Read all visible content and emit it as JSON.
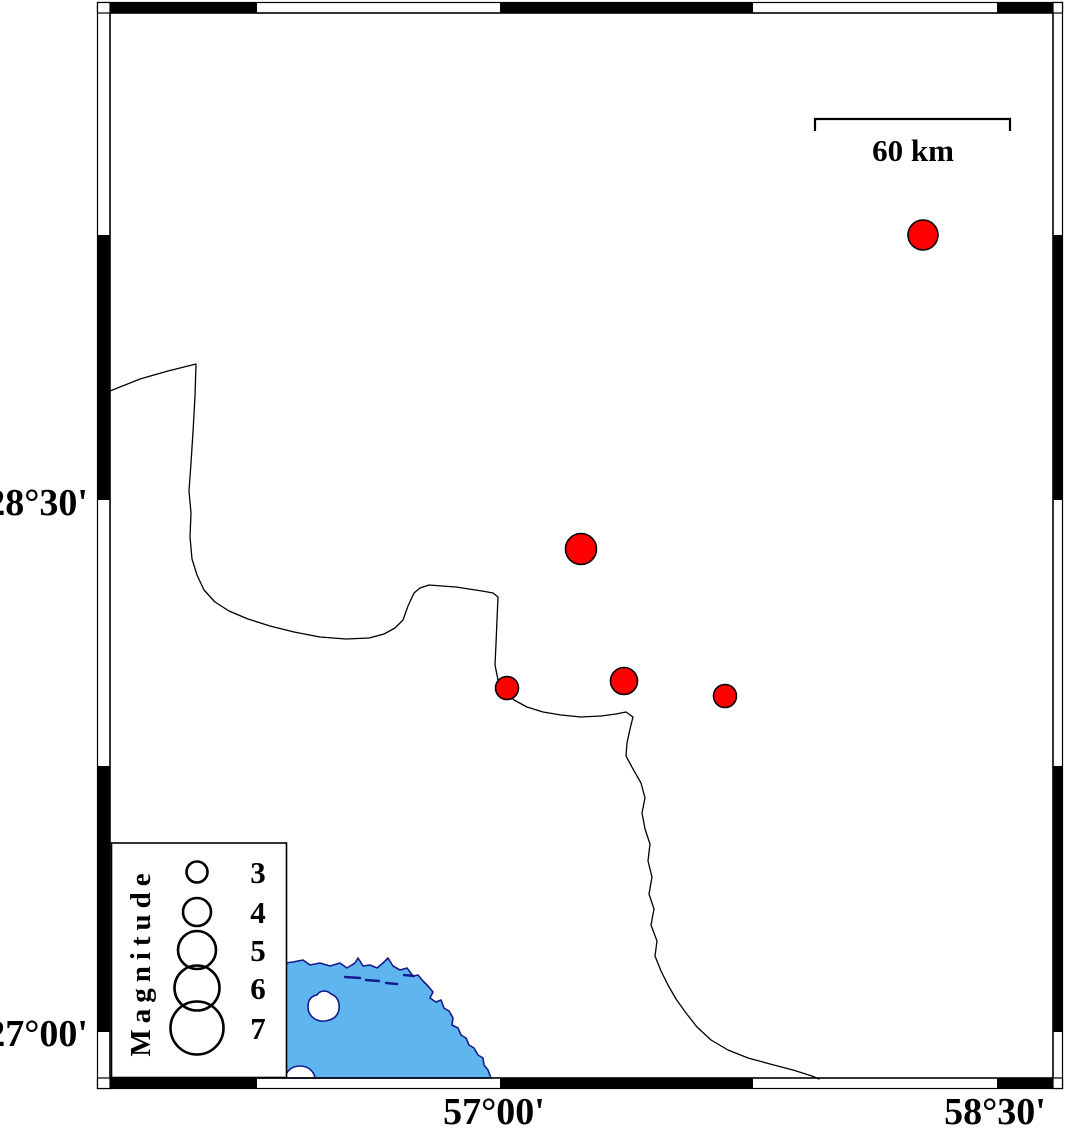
{
  "colors": {
    "sea": "#5fb6ef",
    "coast": "#151b8d",
    "marker": "#ff0000",
    "frame": "#000000"
  },
  "axes": {
    "left": [
      {
        "label": "28°30'",
        "x": 88,
        "y": 515
      },
      {
        "label": "27°00'",
        "x": 88,
        "y": 1046
      }
    ],
    "bottom": [
      {
        "label": "57°00'",
        "x": 494,
        "y": 1124
      },
      {
        "label": "58°30'",
        "x": 995,
        "y": 1124
      }
    ]
  },
  "scale_bar": {
    "label": "60 km",
    "x1": 815,
    "x2": 1010,
    "y": 119,
    "tick": 12,
    "label_x": 913,
    "label_y": 161
  },
  "legend": {
    "title": "Magnitude",
    "box": {
      "x": 111.5,
      "y": 843,
      "w": 175,
      "h": 234.5
    },
    "title_x": 150,
    "title_y": 962,
    "circle_x": 197,
    "num_x": 258,
    "entries": [
      {
        "mag": "3",
        "cy": 872,
        "r": 10.5
      },
      {
        "mag": "4",
        "cy": 912,
        "r": 14
      },
      {
        "mag": "5",
        "cy": 950,
        "r": 19
      },
      {
        "mag": "6",
        "cy": 988,
        "r": 22.5
      },
      {
        "mag": "7",
        "cy": 1028,
        "r": 26.5
      }
    ]
  },
  "markers": [
    {
      "x": 923,
      "y": 235,
      "r": 15
    },
    {
      "x": 581,
      "y": 549,
      "r": 15.5
    },
    {
      "x": 507,
      "y": 688,
      "r": 11.5
    },
    {
      "x": 624,
      "y": 681,
      "r": 13.5
    },
    {
      "x": 725,
      "y": 696,
      "r": 11.5
    }
  ],
  "frame": {
    "outer": {
      "x": 97.5,
      "y": 2.5,
      "w": 965,
      "h": 1086
    },
    "inner": {
      "x": 110,
      "y": 13,
      "w": 943,
      "h": 1065
    },
    "band": {
      "top": [
        2.5,
        13
      ],
      "bottom": [
        1078,
        1088.5
      ],
      "left": [
        97.5,
        110
      ],
      "right": [
        1053,
        1062.5
      ]
    },
    "top_black": [
      [
        110,
        257
      ],
      [
        500,
        753
      ],
      [
        997,
        1053
      ]
    ],
    "bottom_black": [
      [
        110,
        257
      ],
      [
        500,
        753
      ],
      [
        997,
        1053
      ]
    ],
    "left_black": [
      [
        235,
        500
      ],
      [
        766,
        1032
      ]
    ],
    "right_black": [
      [
        235,
        500
      ],
      [
        766,
        1032
      ]
    ]
  },
  "geometry": {
    "border_line": "M 110,391 L 140,379 168,371 196,364 195,396 193,432 191,463 189,491 191,513 190,537 192,559 197,575 204,590 215,602 229,611 248,619 270,626 294,632 320,637 346,639 369,638 384,634 395,628 403,620 408,606 414,593 420,588 429,585 442,586 456,587 469,589 482,591 493,593 498,597 497,620 496,644 495,665 498,680 505,691 514,700 527,707 543,712 561,715 581,717 601,716 616,714 626,712 633,717 630,729 627,743 626,756 633,769 641,783 645,798 642,813 645,829 650,844 648,861 652,877 649,894 654,909 651,925 657,941 655,956 661,971 668,985 676,999 686,1013 697,1027 711,1040 728,1050 748,1058 770,1064 793,1070 812,1076 819,1079",
    "sea": "M 180,978 L 240,972 262,967 278,964 293,962 303,960 310,965 320,963 330,966 340,963 347,968 355,963 358,958 363,966 370,965 377,968 383,963 388,958 393,966 400,970 407,968 413,976 418,975 423,981 428,986 433,992 430,998 436,1002 441,1000 444,1008 449,1011 453,1018 452,1025 458,1028 461,1035 466,1038 469,1045 474,1048 478,1055 483,1058 484,1065 488,1070 491,1078 L 180,1078 Z",
    "island": "M 308,1007 C 308,1000 311,996 317,995 C 320,990 327,990 331,994 C 337,996 340,1002 339,1009 C 338,1016 333,1020 325,1021 C 316,1022 308,1016 308,1007 Z",
    "island_small": "M 285,1078 C 286,1071 292,1066 300,1066 C 308,1066 314,1071 315,1078 Z",
    "coast_dashes": "M 345,977 L 360,978 M 366,980 L 379,981 M 386,983 L 397,984 M 404,975 L 414,976"
  }
}
